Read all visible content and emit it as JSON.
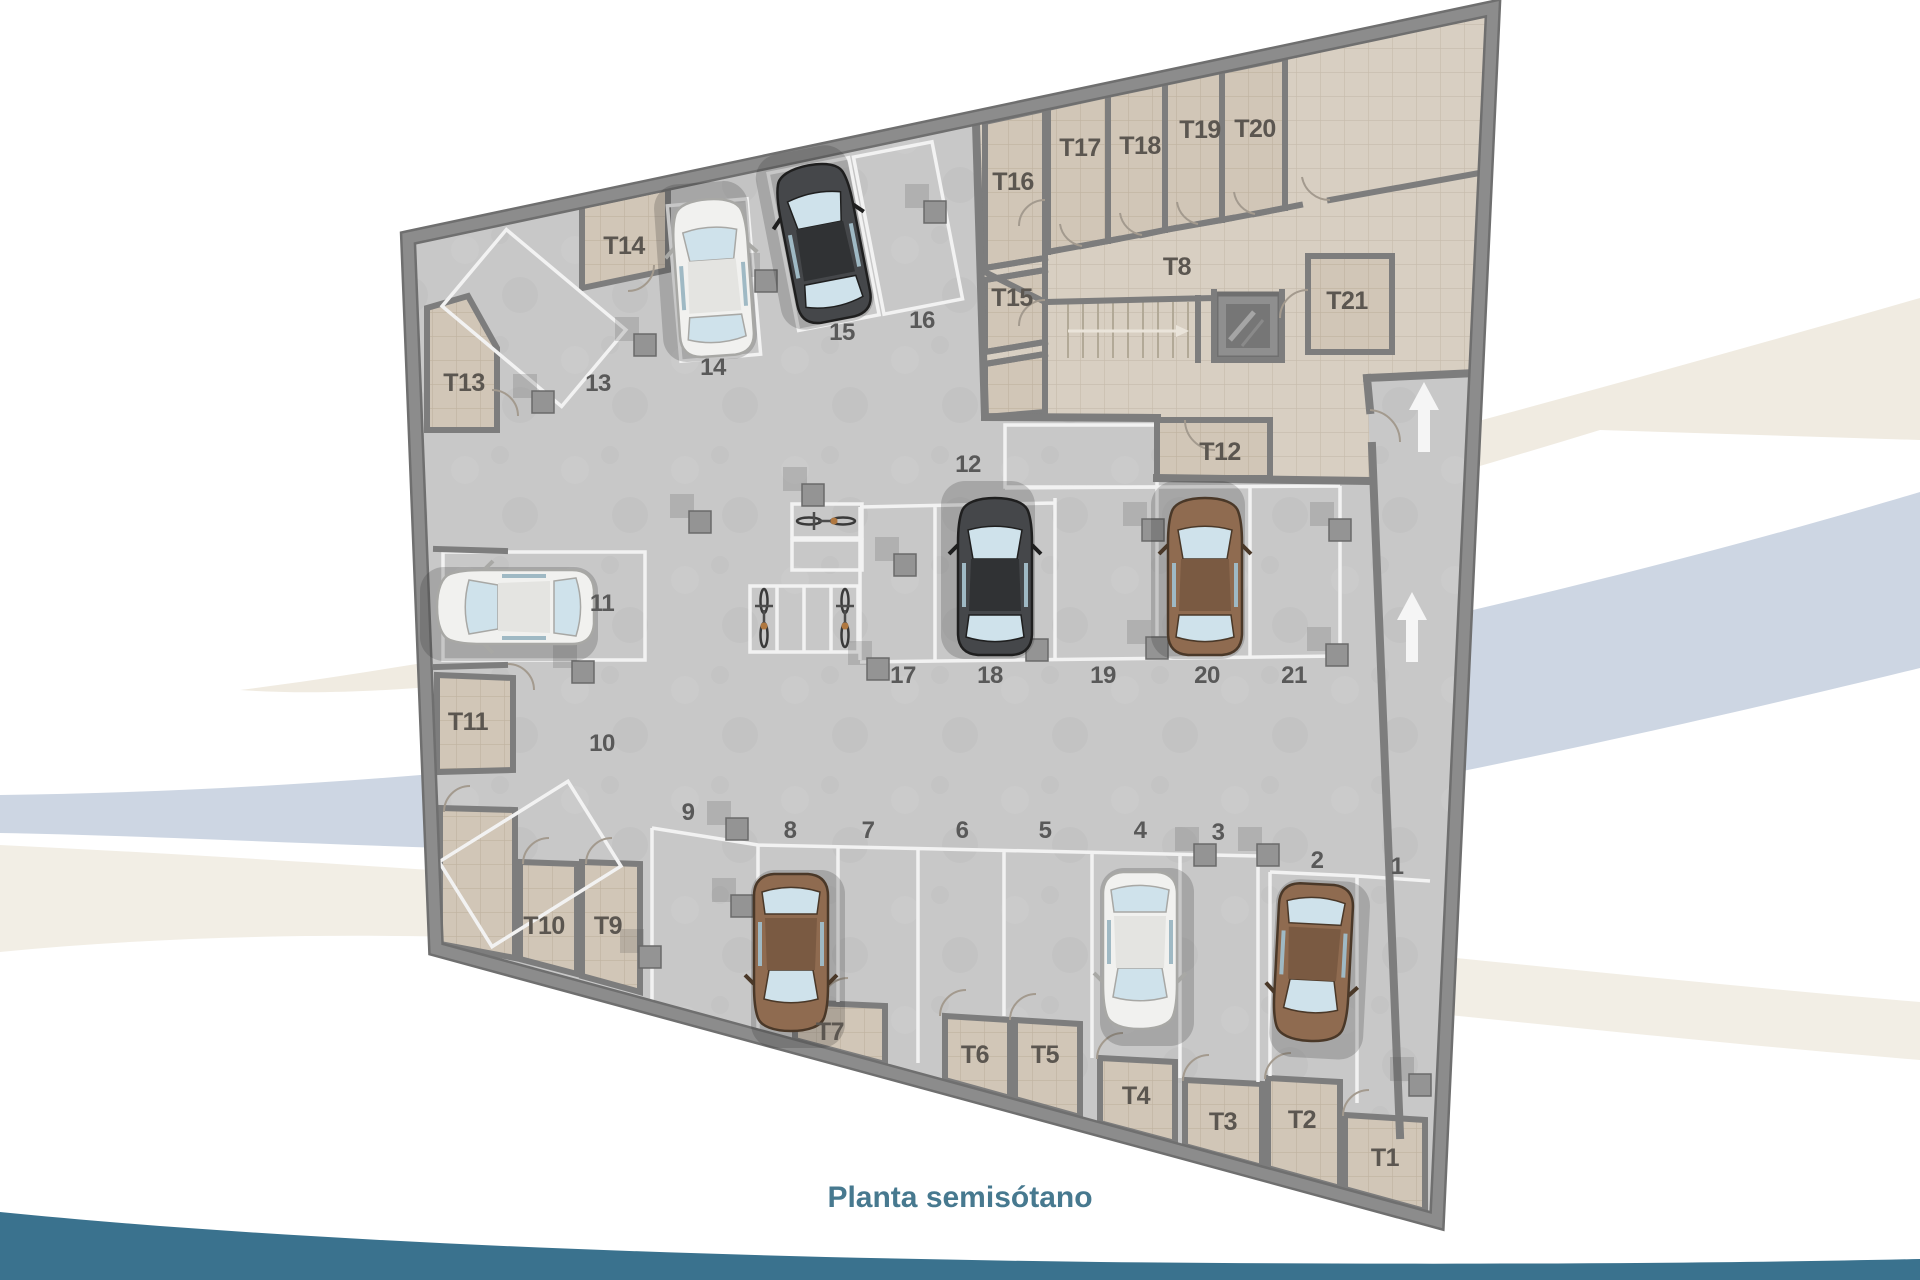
{
  "title": {
    "text": "Planta semisótano"
  },
  "labels": {
    "p1": "1",
    "p2": "2",
    "p3": "3",
    "p4": "4",
    "p5": "5",
    "p6": "6",
    "p7": "7",
    "p8": "8",
    "p9": "9",
    "p10": "10",
    "p11": "11",
    "p12": "12",
    "p13": "13",
    "p14": "14",
    "p15": "15",
    "p16": "16",
    "p17": "17",
    "p18": "18",
    "p19": "19",
    "p20": "20",
    "p21": "21",
    "t1": "T1",
    "t2": "T2",
    "t3": "T3",
    "t4": "T4",
    "t5": "T5",
    "t6": "T6",
    "t7": "T7",
    "t8": "T8",
    "t9": "T9",
    "t10": "T10",
    "t11": "T11",
    "t12": "T12",
    "t13": "T13",
    "t14": "T14",
    "t15": "T15",
    "t16": "T16",
    "t17": "T17",
    "t18": "T18",
    "t19": "T19",
    "t20": "T20",
    "t21": "T21"
  },
  "plan": {
    "type": "parking-floor-plan",
    "parking_spot_count": 21,
    "storage_room_count": 21,
    "occupied_spots": [
      "2",
      "4",
      "8",
      "11",
      "14",
      "15",
      "18",
      "20"
    ],
    "cars": [
      {
        "spot": "15",
        "color": "#45474a"
      },
      {
        "spot": "14",
        "color": "#f1f1ef"
      },
      {
        "spot": "18",
        "color": "#45474a"
      },
      {
        "spot": "20",
        "color": "#8f6b50"
      },
      {
        "spot": "11",
        "color": "#f1f1ef"
      },
      {
        "spot": "8",
        "color": "#8f6b50"
      },
      {
        "spot": "4",
        "color": "#f1f1ef"
      },
      {
        "spot": "2",
        "color": "#8f6b50"
      }
    ],
    "bicycle_count": 3,
    "ramp_arrows": {
      "icon": "up-arrow",
      "count": 2
    },
    "features": [
      "staircase",
      "elevator-shaft",
      "structural-columns"
    ]
  },
  "colors": {
    "garage_floor": "#c8c8c8",
    "storage_floor": "#d8cfc2",
    "wall": "#7d7d7d",
    "parking_line": "#f2f2f2",
    "accent_teal": "#3a728e",
    "title_text": "#47798f",
    "swoosh_blue": "#cdd6e3",
    "swoosh_beige": "#f0ebe1"
  }
}
